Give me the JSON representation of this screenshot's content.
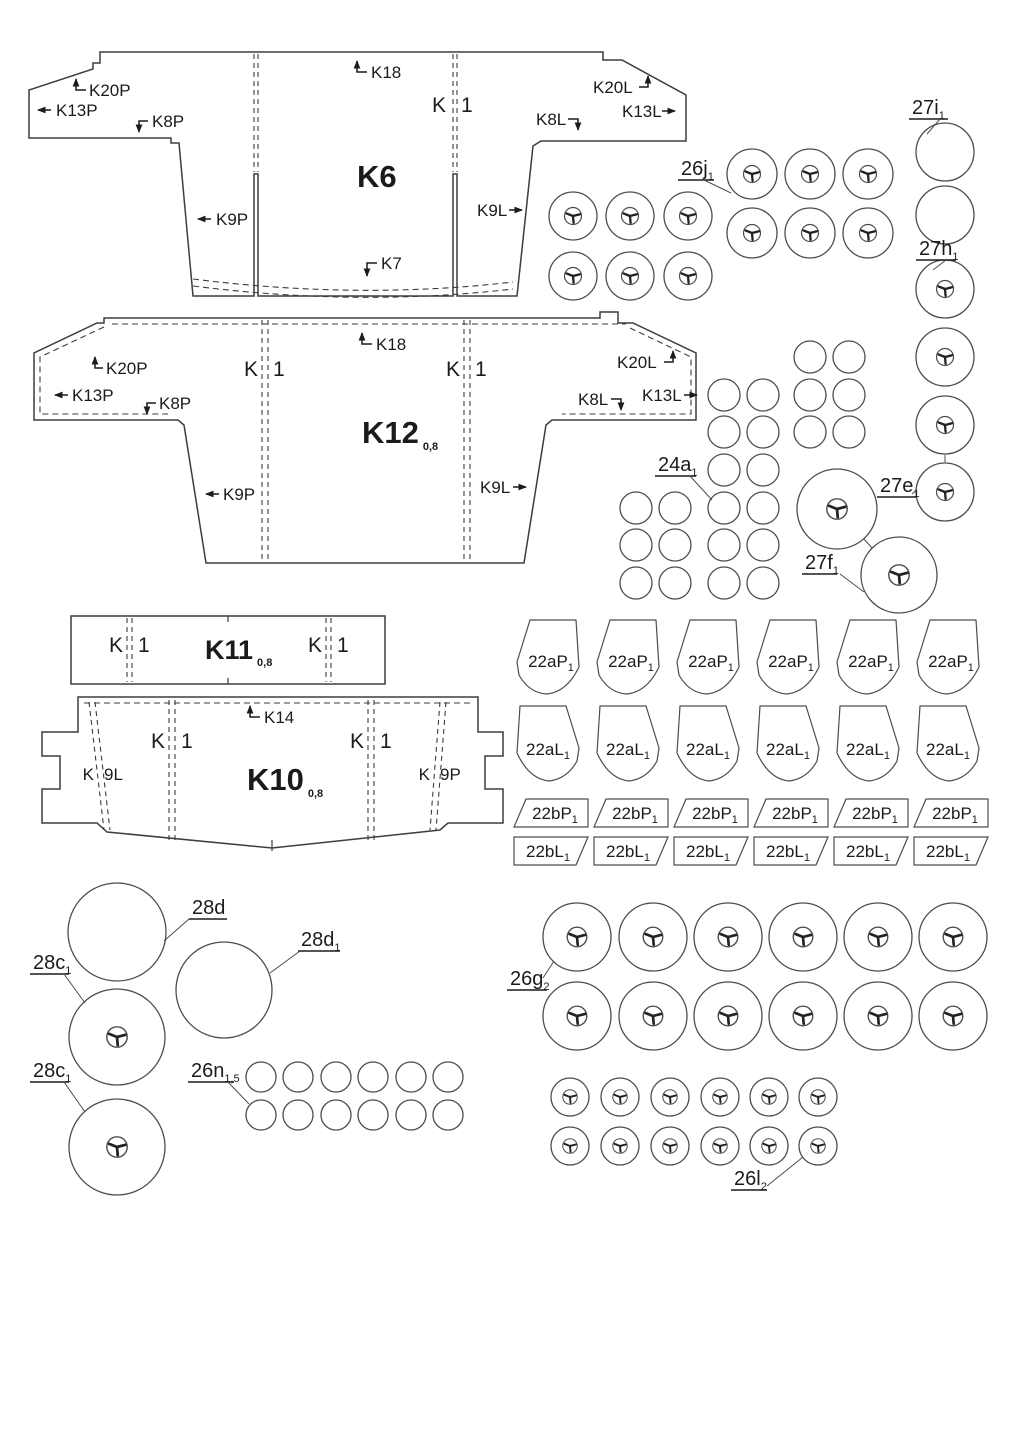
{
  "colors": {
    "ink": "#1b1b1b",
    "line": "#4d4d4d",
    "background": "#ffffff"
  },
  "panels": {
    "k6": {
      "title": "K6",
      "slot_left": "K",
      "slot_right": "1",
      "arrows": {
        "k18": "K18",
        "k20p": "K20P",
        "k13p": "K13P",
        "k8p": "K8P",
        "k9p": "K9P",
        "k9l": "K9L",
        "k7": "K7",
        "k8l": "K8L",
        "k13l": "K13L",
        "k20l": "K20L"
      }
    },
    "k12": {
      "title": "K12",
      "thickness": "0,8",
      "slot_left": "K",
      "slot_right": "1",
      "arrows": {
        "k18": "K18",
        "k20p": "K20P",
        "k13p": "K13P",
        "k8p": "K8P",
        "k9p": "K9P",
        "k9l": "K9L",
        "k8l": "K8L",
        "k13l": "K13L",
        "k20l": "K20L"
      }
    },
    "k11": {
      "title": "K11",
      "thickness": "0,8",
      "slot_left": "K",
      "slot_right": "1"
    },
    "k10": {
      "title": "K10",
      "thickness": "0,8",
      "slot_left": "K",
      "slot_right": "1",
      "arrows": {
        "k14": "K14"
      },
      "glue_left": {
        "a": "K",
        "b": "9L"
      },
      "glue_right": {
        "a": "K",
        "b": "9P"
      }
    }
  },
  "part_labels": {
    "p27i": {
      "text": "27i",
      "sub": "1"
    },
    "p26j": {
      "text": "26j",
      "sub": "1"
    },
    "p27h": {
      "text": "27h",
      "sub": "1"
    },
    "p24a": {
      "text": "24a",
      "sub": "1"
    },
    "p27e": {
      "text": "27e",
      "sub": "1"
    },
    "p27f": {
      "text": "27f",
      "sub": "1"
    },
    "p22aP": {
      "text": "22aP",
      "sub": "1"
    },
    "p22aL": {
      "text": "22aL",
      "sub": "1"
    },
    "p22bP": {
      "text": "22bP",
      "sub": "1"
    },
    "p22bL": {
      "text": "22bL",
      "sub": "1"
    },
    "p28d": {
      "text": "28d",
      "sub": ""
    },
    "p28d1": {
      "text": "28d",
      "sub": "1"
    },
    "p28c1": {
      "text": "28c",
      "sub": "1"
    },
    "p26n": {
      "text": "26n",
      "sub": "1,5"
    },
    "p26g": {
      "text": "26g",
      "sub": "2"
    },
    "p26l": {
      "text": "26l",
      "sub": "2"
    }
  }
}
